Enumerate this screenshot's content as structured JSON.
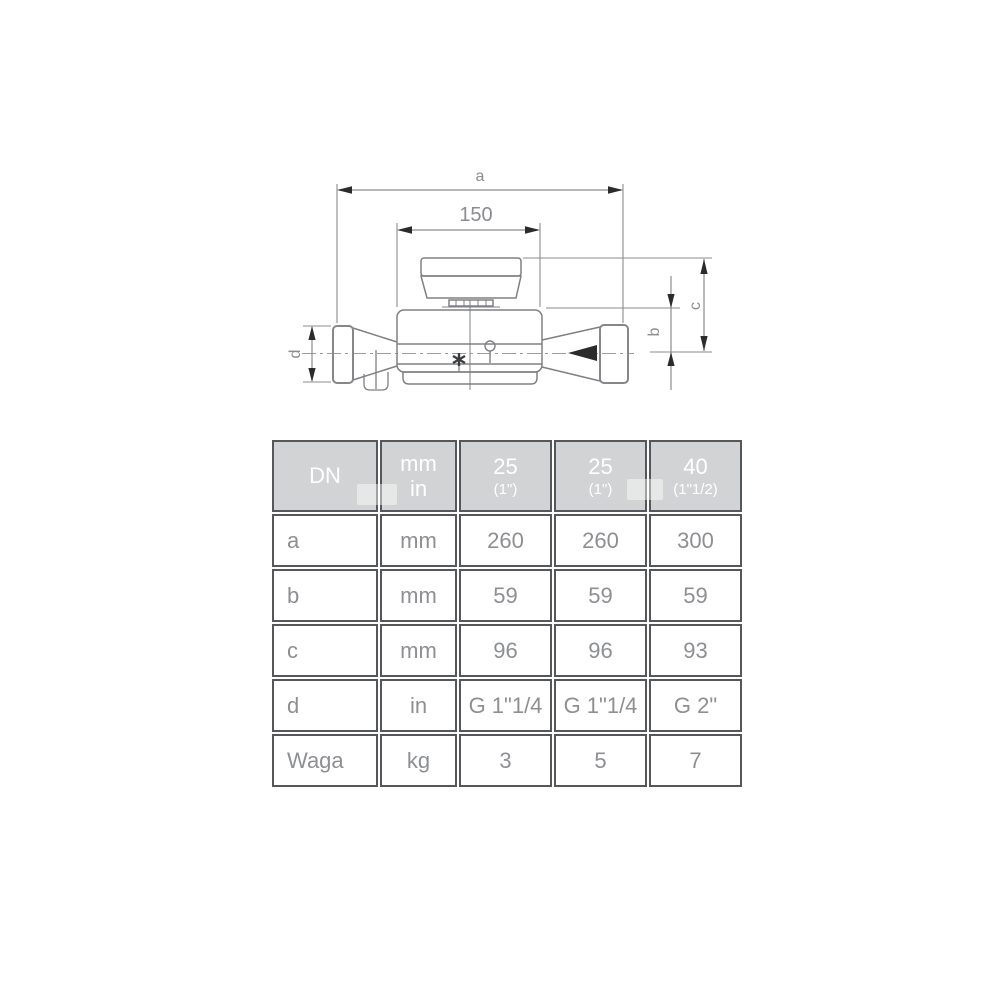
{
  "drawing": {
    "dim_a": "a",
    "dim_150": "150",
    "dim_b": "b",
    "dim_c": "c",
    "dim_d": "d"
  },
  "table": {
    "header": {
      "dn": "DN",
      "unit_line1": "mm",
      "unit_line2": "in",
      "sizes": [
        {
          "dn": "25",
          "inch": "(1\")"
        },
        {
          "dn": "25",
          "inch": "(1\")"
        },
        {
          "dn": "40",
          "inch": "(1\"1/2)"
        }
      ]
    },
    "rows": [
      {
        "label": "a",
        "unit": "mm",
        "values": [
          "260",
          "260",
          "300"
        ]
      },
      {
        "label": "b",
        "unit": "mm",
        "values": [
          "59",
          "59",
          "59"
        ]
      },
      {
        "label": "c",
        "unit": "mm",
        "values": [
          "96",
          "96",
          "93"
        ]
      },
      {
        "label": "d",
        "unit": "in",
        "values": [
          "G 1\"1/4",
          "G 1\"1/4",
          "G 2\""
        ]
      },
      {
        "label": "Waga",
        "unit": "kg",
        "values": [
          "3",
          "5",
          "7"
        ]
      }
    ],
    "colors": {
      "header_bg": "#d1d3d4",
      "header_text": "#ffffff",
      "border": "#55575a",
      "cell_text": "#8d8f92"
    }
  }
}
